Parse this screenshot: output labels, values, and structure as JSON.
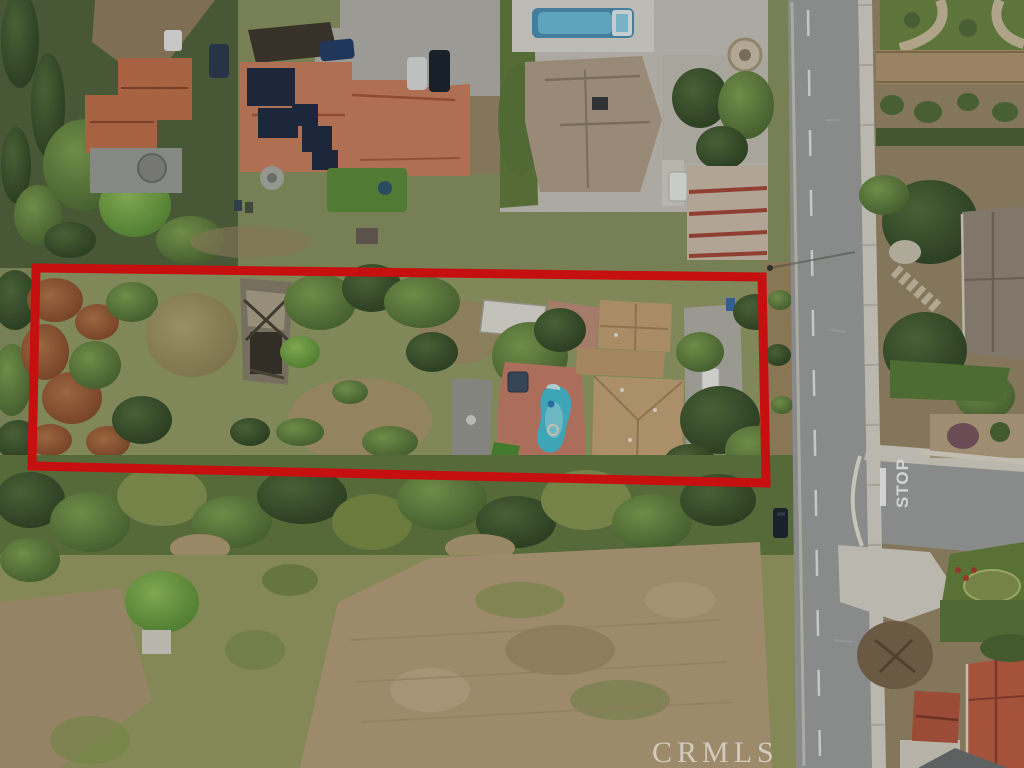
{
  "meta": {
    "type": "aerial-photograph",
    "width_px": 1024,
    "height_px": 768
  },
  "watermark": {
    "text": "CRMLS",
    "color": "#ffffff"
  },
  "road": {
    "pavement_marking": "STOP",
    "marking_color": "#ffffff"
  },
  "boundary": {
    "shape": "polygon",
    "points": "36,268 762,277 766,483 32,466",
    "color": "#e81313",
    "stroke_width": 9
  },
  "palette": {
    "grass_base": "#8a9663",
    "scrub_green": "#647b43",
    "dirt_tan": "#b3a078",
    "lot_dirt": "#b7a27e",
    "road_asphalt": "#9fa3a2",
    "sidewalk": "#d9d6cc",
    "tile_roof_orange": "#cd8261",
    "tile_roof_red": "#c26046",
    "parcel_roof_tan": "#c9a87b",
    "gray_roof": "#978b7c",
    "pool_blue": "#4f94b8",
    "pool_cyan": "#49c2d6",
    "solar_panel": "#232e45"
  }
}
